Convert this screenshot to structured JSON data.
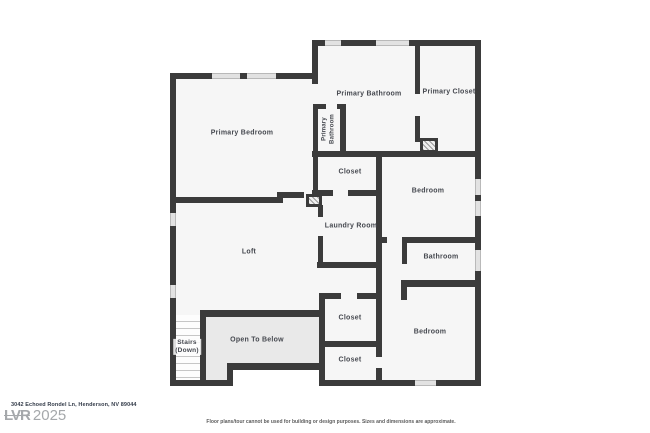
{
  "colors": {
    "wall": "#3b3b3b",
    "room_fill": "#f6f6f6",
    "open_fill": "#e9e9e9",
    "window_fill": "#e2e2e2",
    "label": "#45484f"
  },
  "rooms": {
    "primary_bedroom": "Primary Bedroom",
    "primary_bathroom": "Primary Bathroom",
    "primary_bathroom_wc_line1": "Primary",
    "primary_bathroom_wc_line2": "Bathroom",
    "primary_closet": "Primary Closet",
    "closet_hall": "Closet",
    "bedroom_upper": "Bedroom",
    "laundry": "Laundry Room",
    "loft": "Loft",
    "bathroom": "Bathroom",
    "closet_top": "Closet",
    "bedroom_lower": "Bedroom",
    "closet_bottom": "Closet",
    "stairs_line1": "Stairs",
    "stairs_line2": "(Down)",
    "open_to_below": "Open To Below"
  },
  "footer": {
    "address": "3042 Echoed Rondel Ln, Henderson, NV 89044",
    "watermark_logo": "LVR",
    "watermark_year": "2025",
    "disclaimer": "Floor plans/tour cannot be used for building or design purposes. Sizes and dimensions are approximate."
  }
}
